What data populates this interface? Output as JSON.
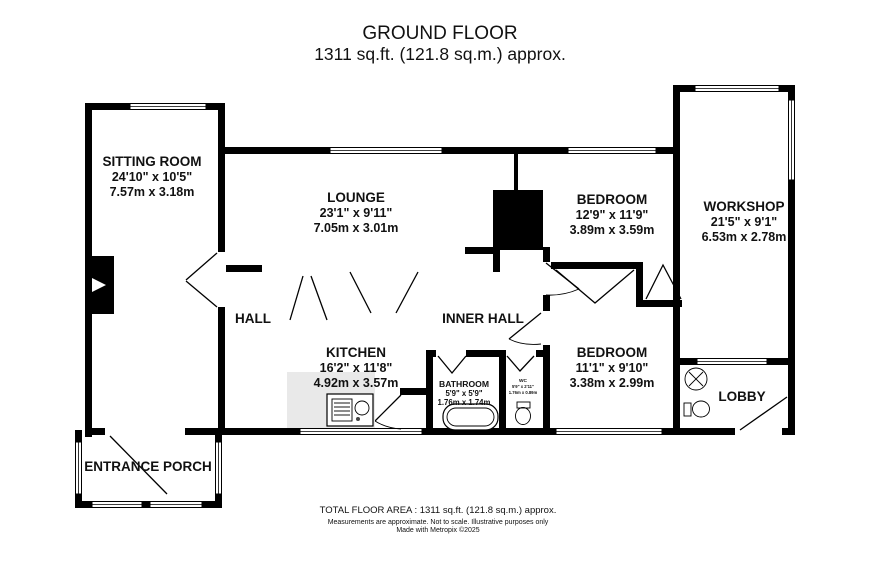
{
  "title": {
    "line1": "GROUND FLOOR",
    "line2": "1311 sq.ft. (121.8 sq.m.) approx."
  },
  "rooms": {
    "sitting_room": {
      "name": "SITTING ROOM",
      "imperial": "24'10\" x 10'5\"",
      "metric": "7.57m x 3.18m"
    },
    "lounge": {
      "name": "LOUNGE",
      "imperial": "23'1\" x 9'11\"",
      "metric": "7.05m x 3.01m"
    },
    "bedroom_top": {
      "name": "BEDROOM",
      "imperial": "12'9\" x 11'9\"",
      "metric": "3.89m x 3.59m"
    },
    "workshop": {
      "name": "WORKSHOP",
      "imperial": "21'5\" x 9'1\"",
      "metric": "6.53m x 2.78m"
    },
    "hall": {
      "name": "HALL"
    },
    "inner_hall": {
      "name": "INNER HALL"
    },
    "kitchen": {
      "name": "KITCHEN",
      "imperial": "16'2\" x 11'8\"",
      "metric": "4.92m x 3.57m"
    },
    "bedroom_bottom": {
      "name": "BEDROOM",
      "imperial": "11'1\" x 9'10\"",
      "metric": "3.38m x 2.99m"
    },
    "bathroom": {
      "name": "BATHROOM",
      "imperial": "5'9\" x 5'9\"",
      "metric": "1.76m x 1.74m"
    },
    "wc": {
      "name": "WC",
      "imperial": "5'9\" x 2'11\"",
      "metric": "1.76m x 0.89m"
    },
    "lobby": {
      "name": "LOBBY"
    },
    "entrance_porch": {
      "name": "ENTRANCE PORCH"
    }
  },
  "footer": {
    "line1": "TOTAL FLOOR AREA : 1311 sq.ft. (121.8 sq.m.) approx.",
    "line2": "Measurements are approximate.  Not to scale.  Illustrative purposes only",
    "line3": "Made with Metropix ©2025"
  },
  "colors": {
    "wall": "#000000",
    "counter": "#e9e9e9"
  }
}
